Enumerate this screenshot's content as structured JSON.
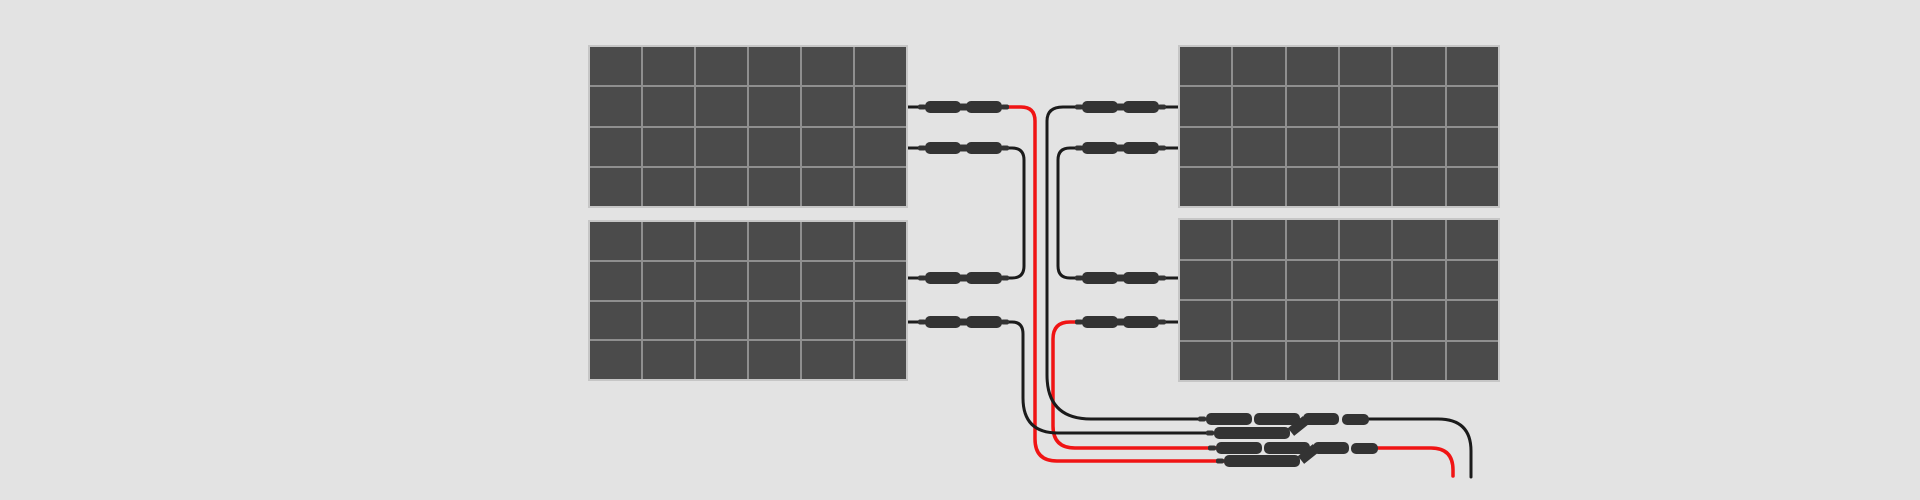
{
  "diagram": {
    "type": "solar-panel-wiring-diagram",
    "panel_count": 4,
    "panels": [
      {
        "id": "top-left",
        "columns": 6,
        "rows": 4
      },
      {
        "id": "bottom-left",
        "columns": 6,
        "rows": 4
      },
      {
        "id": "top-right",
        "columns": 6,
        "rows": 4
      },
      {
        "id": "bottom-right",
        "columns": 6,
        "rows": 4
      }
    ],
    "wiring": {
      "inline_connector_pairs": 8,
      "series_links": 2,
      "branch_connector_assemblies": 2,
      "output_leads": [
        {
          "color": "black"
        },
        {
          "color": "red"
        }
      ]
    },
    "colors": {
      "background": "#e3e3e3",
      "panel_cell": "#4b4b4b",
      "panel_grid_line": "#8f8f8f",
      "panel_border": "#c6c6c6",
      "wire_black": "#1b1b1b",
      "wire_red": "#f01414",
      "connector_body": "#333333"
    }
  }
}
